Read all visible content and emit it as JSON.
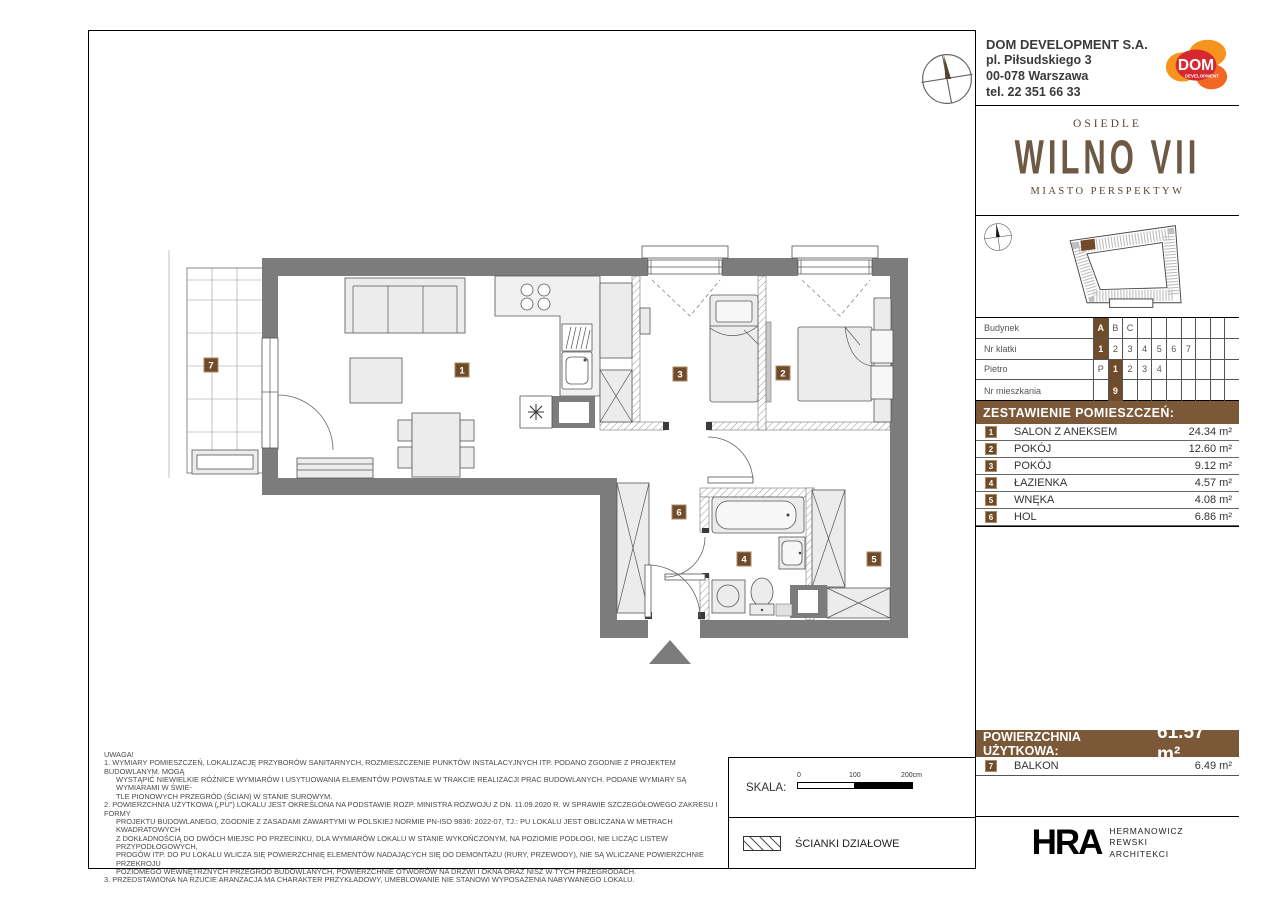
{
  "header": {
    "company": {
      "name": "DOM DEVELOPMENT S.A.",
      "address1": "pl. Piłsudskiego 3",
      "address2": "00-078 Warszawa",
      "phone": "tel. 22 351 66 33"
    },
    "logo": {
      "brand": "DOM",
      "sub": "DEVELOPMENT"
    },
    "estate": {
      "pre": "OSIEDLE",
      "name": "WILNO VII",
      "tagline": "MIASTO PERSPEKTYW"
    }
  },
  "building_table": {
    "rows": [
      {
        "label": "Budynek",
        "cells": [
          "A",
          "B",
          "C",
          "",
          "",
          "",
          "",
          "",
          "",
          ""
        ]
      },
      {
        "label": "Nr klatki",
        "cells": [
          "1",
          "2",
          "3",
          "4",
          "5",
          "6",
          "7",
          "",
          "",
          ""
        ]
      },
      {
        "label": "Pietro",
        "cells": [
          "P",
          "1",
          "2",
          "3",
          "4",
          "",
          "",
          "",
          "",
          ""
        ]
      },
      {
        "label": "Nr mieszkania",
        "cells": [
          "",
          "9",
          "",
          "",
          "",
          "",
          "",
          "",
          "",
          ""
        ]
      }
    ]
  },
  "rooms": {
    "title": "ZESTAWIENIE POMIESZCZEŃ:",
    "list": [
      {
        "nr": "1",
        "name": "SALON Z ANEKSEM",
        "area": "24.34 m²"
      },
      {
        "nr": "2",
        "name": "POKÓJ",
        "area": "12.60 m²"
      },
      {
        "nr": "3",
        "name": "POKÓJ",
        "area": "9.12 m²"
      },
      {
        "nr": "4",
        "name": "ŁAZIENKA",
        "area": "4.57 m²"
      },
      {
        "nr": "5",
        "name": "WNĘKA",
        "area": "4.08 m²"
      },
      {
        "nr": "6",
        "name": "HOL",
        "area": "6.86 m²"
      }
    ]
  },
  "summary": {
    "label": "POWIERZCHNIA UŻYTKOWA:",
    "value": "61.57 m²",
    "balcony": {
      "nr": "7",
      "name": "BALKON",
      "area": "6.49 m²"
    }
  },
  "plan": {
    "badges": {
      "b1": "1",
      "b2": "2",
      "b3": "3",
      "b4": "4",
      "b5": "5",
      "b6": "6",
      "b7": "7"
    }
  },
  "notes": {
    "title": "UWAGA!",
    "lines": [
      "1. WYMIARY POMIESZCZEŃ, LOKALIZACJĘ PRZYBORÓW SANITARNYCH, ROZMIESZCZENIE PUNKTÓW INSTALACYJNYCH ITP. PODANO ZGODNIE Z PROJEKTEM BUDOWLANYM. MOGĄ",
      "WYSTĄPIĆ NIEWIELKIE RÓŻNICE WYMIARÓW I USYTUOWANIA ELEMENTÓW POWSTAŁE W TRAKCIE REALIZACJI PRAC BUDOWLANYCH. PODANE WYMIARY SĄ WYMIARAMI W ŚWIE-",
      "TLE PIONOWYCH PRZEGRÓD (ŚCIAN) W STANIE SUROWYM.",
      "2. POWIERZCHNIA UŻYTKOWA („PU\") LOKALU JEST OKREŚLONA NA PODSTAWIE ROZP. MINISTRA ROZWOJU Z DN. 11.09.2020 R. W SPRAWIE SZCZEGÓŁOWEGO ZAKRESU I FORMY",
      "PROJEKTU BUDOWLANEGO, ZGODNIE Z ZASADAMI ZAWARTYMI W POLSKIEJ NORMIE PN-ISO 9836: 2022-07, TJ.: PU LOKALU JEST OBLICZANA W METRACH KWADRATOWYCH",
      "Z DOKŁADNOŚCIĄ DO DWÓCH MIEJSC PO PRZECINKU, DLA WYMIARÓW LOKALU W STANIE WYKOŃCZONYM, NA POZIOMIE PODŁOGI, NIE LICZĄC LISTEW PRZYPODŁOGOWYCH,",
      "PROGÓW ITP. DO PU LOKALU WLICZA SIĘ POWIERZCHNIĘ ELEMENTÓW NADAJĄCYCH SIĘ DO DEMONTAŻU (RURY, PRZEWODY), NIE SĄ WLICZANE POWIERZCHNIE PRZEKROJU",
      "POZIOMEGO WEWNĘTRZNYCH PRZEGRÓD BUDOWLANYCH, POWIERZCHNIE OTWORÓW NA DRZWI I OKNA ORAZ NISZ W TYCH PRZEGRODACH.",
      "3. PRZEDSTAWIONA NA RZUCIE ARANŻACJA MA CHARAKTER PRZYKŁADOWY, UMEBLOWANIE NIE STANOWI WYPOSAŻENIA NABYWANEGO LOKALU."
    ]
  },
  "scale": {
    "label": "SKALA:",
    "t0": "0",
    "t1": "100",
    "t2": "200cm"
  },
  "legend": {
    "partition": "ŚCIANKI DZIAŁOWE"
  },
  "architect": {
    "logo": "HRA",
    "line1": "HERMANOWICZ",
    "line2": "REWSKI",
    "line3": "ARCHITEKCI"
  },
  "colors": {
    "accent_brown": "#6F4B2A",
    "bar_brown": "#7A5838",
    "wall_gray": "#7C7C7C",
    "logo_orange": "#F7941D",
    "logo_red": "#D7282F",
    "wilno_brown": "#6E5A44"
  }
}
